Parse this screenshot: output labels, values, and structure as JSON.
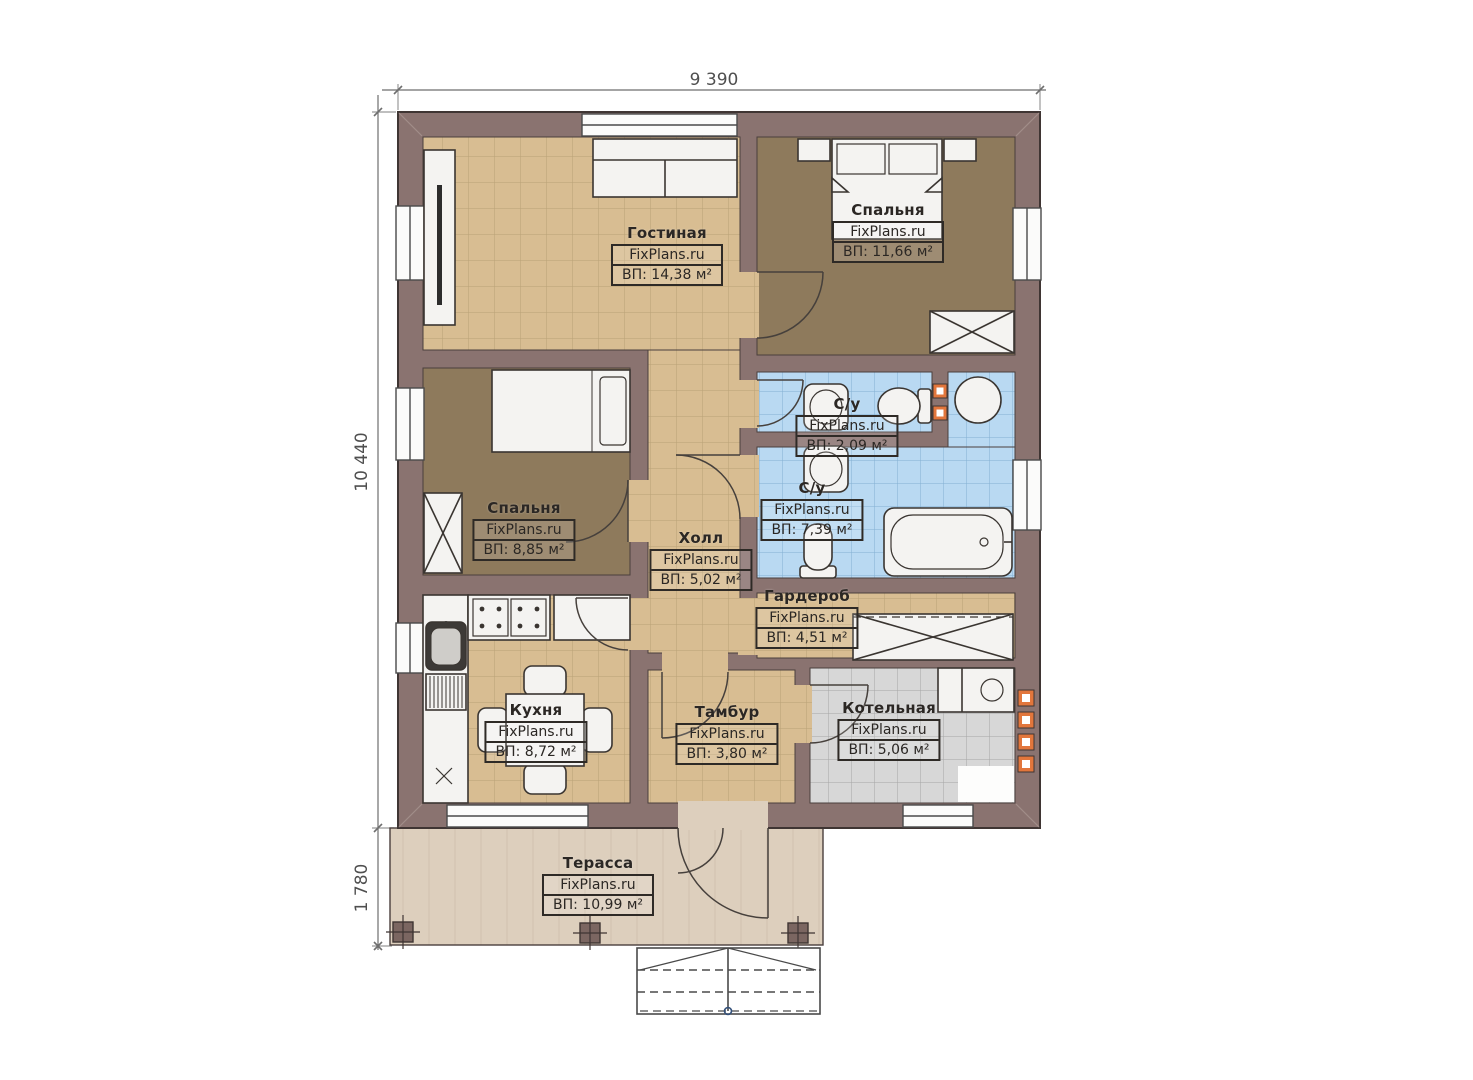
{
  "plan": {
    "brand": "FixPlans.ru",
    "dimensions": {
      "width_top": "9 390",
      "height_left": "10 440",
      "terrace_depth": "1 780"
    },
    "rooms": [
      {
        "key": "living",
        "name": "Гостиная",
        "area": "ВП: 14,38 м²"
      },
      {
        "key": "bedroom-1",
        "name": "Спальня",
        "area": "ВП: 11,66 м²"
      },
      {
        "key": "wc-small",
        "name": "С/у",
        "area": "ВП: 2,09 м²"
      },
      {
        "key": "wc-large",
        "name": "С/у",
        "area": "ВП: 7,39 м²"
      },
      {
        "key": "bedroom-2",
        "name": "Спальня",
        "area": "ВП: 8,85 м²"
      },
      {
        "key": "hall",
        "name": "Холл",
        "area": "ВП: 5,02 м²"
      },
      {
        "key": "wardrobe",
        "name": "Гардероб",
        "area": "ВП: 4,51 м²"
      },
      {
        "key": "kitchen",
        "name": "Кухня",
        "area": "ВП: 8,72 м²"
      },
      {
        "key": "tambour",
        "name": "Тамбур",
        "area": "ВП: 3,80 м²"
      },
      {
        "key": "boiler",
        "name": "Котельная",
        "area": "ВП: 5,06 м²"
      },
      {
        "key": "terrace",
        "name": "Терасса",
        "area": "ВП: 10,99 м²"
      }
    ],
    "colors": {
      "wall": "#8a7370",
      "tile_beige": "#d8bd92",
      "carpet_brown": "#8e7a5c",
      "tile_blue": "#b9d9f2",
      "tile_gray": "#d7d7d7",
      "terrace_deck": "#ddcfbd",
      "vent_orange": "#e2763c"
    }
  }
}
